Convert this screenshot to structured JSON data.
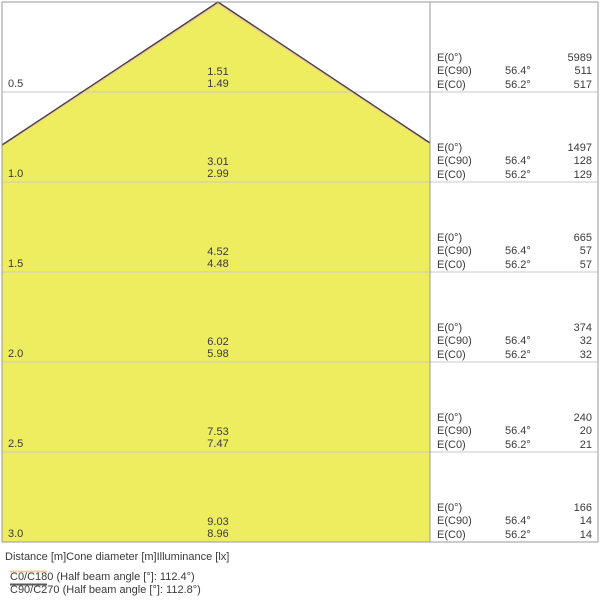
{
  "colors": {
    "cone_fill": "#EDED5F",
    "cone_outline_dark": "#46423A",
    "cone_outline_orange": "#F0C9A0",
    "legend_c0_line": "#F2CDA2",
    "legend_c90_line": "#5A5A5A"
  },
  "rows": [
    {
      "distance": "0.5",
      "diameters": [
        "1.51",
        "1.49"
      ],
      "table": [
        {
          "label": "E(0°)",
          "angle": "",
          "value": "5989"
        },
        {
          "label": "E(C90)",
          "angle": "56.4°",
          "value": "511"
        },
        {
          "label": "E(C0)",
          "angle": "56.2°",
          "value": "517"
        }
      ]
    },
    {
      "distance": "1.0",
      "diameters": [
        "3.01",
        "2.99"
      ],
      "table": [
        {
          "label": "E(0°)",
          "angle": "",
          "value": "1497"
        },
        {
          "label": "E(C90)",
          "angle": "56.4°",
          "value": "128"
        },
        {
          "label": "E(C0)",
          "angle": "56.2°",
          "value": "129"
        }
      ]
    },
    {
      "distance": "1.5",
      "diameters": [
        "4.52",
        "4.48"
      ],
      "table": [
        {
          "label": "E(0°)",
          "angle": "",
          "value": "665"
        },
        {
          "label": "E(C90)",
          "angle": "56.4°",
          "value": "57"
        },
        {
          "label": "E(C0)",
          "angle": "56.2°",
          "value": "57"
        }
      ]
    },
    {
      "distance": "2.0",
      "diameters": [
        "6.02",
        "5.98"
      ],
      "table": [
        {
          "label": "E(0°)",
          "angle": "",
          "value": "374"
        },
        {
          "label": "E(C90)",
          "angle": "56.4°",
          "value": "32"
        },
        {
          "label": "E(C0)",
          "angle": "56.2°",
          "value": "32"
        }
      ]
    },
    {
      "distance": "2.5",
      "diameters": [
        "7.53",
        "7.47"
      ],
      "table": [
        {
          "label": "E(0°)",
          "angle": "",
          "value": "240"
        },
        {
          "label": "E(C90)",
          "angle": "56.4°",
          "value": "20"
        },
        {
          "label": "E(C0)",
          "angle": "56.2°",
          "value": "21"
        }
      ]
    },
    {
      "distance": "3.0",
      "diameters": [
        "9.03",
        "8.96"
      ],
      "table": [
        {
          "label": "E(0°)",
          "angle": "",
          "value": "166"
        },
        {
          "label": "E(C90)",
          "angle": "56.4°",
          "value": "14"
        },
        {
          "label": "E(C0)",
          "angle": "56.2°",
          "value": "14"
        }
      ]
    }
  ],
  "caption": "Distance [m]Cone diameter [m]Illuminance [lx]",
  "legend": [
    {
      "label": "C0/C180 (Half beam angle [°]: 112.4°)",
      "color": "#F2CDA2"
    },
    {
      "label": "C90/C270 (Half beam angle [°]: 112.8°)",
      "color": "#5A5A5A"
    }
  ],
  "chart_data": {
    "type": "table",
    "title": "Luminous cone diagram (distance vs. cone diameter and illuminance)",
    "distances_m": [
      0.5,
      1.0,
      1.5,
      2.0,
      2.5,
      3.0
    ],
    "cone_diameter_m_c90_c270": [
      1.51,
      3.01,
      4.52,
      6.02,
      7.53,
      9.03
    ],
    "cone_diameter_m_c0_c180": [
      1.49,
      2.99,
      4.48,
      5.98,
      7.47,
      8.96
    ],
    "illuminance_lx_E0": [
      5989,
      1497,
      665,
      374,
      240,
      166
    ],
    "illuminance_lx_EC90": [
      511,
      128,
      57,
      32,
      20,
      14
    ],
    "illuminance_lx_EC0": [
      517,
      129,
      57,
      32,
      21,
      14
    ],
    "beam_angle_C90": "56.4°",
    "beam_angle_C0": "56.2°",
    "half_beam_angle_C0_C180_deg": 112.4,
    "half_beam_angle_C90_C270_deg": 112.8,
    "columns_legend": "Distance [m]Cone diameter [m]Illuminance [lx]"
  }
}
